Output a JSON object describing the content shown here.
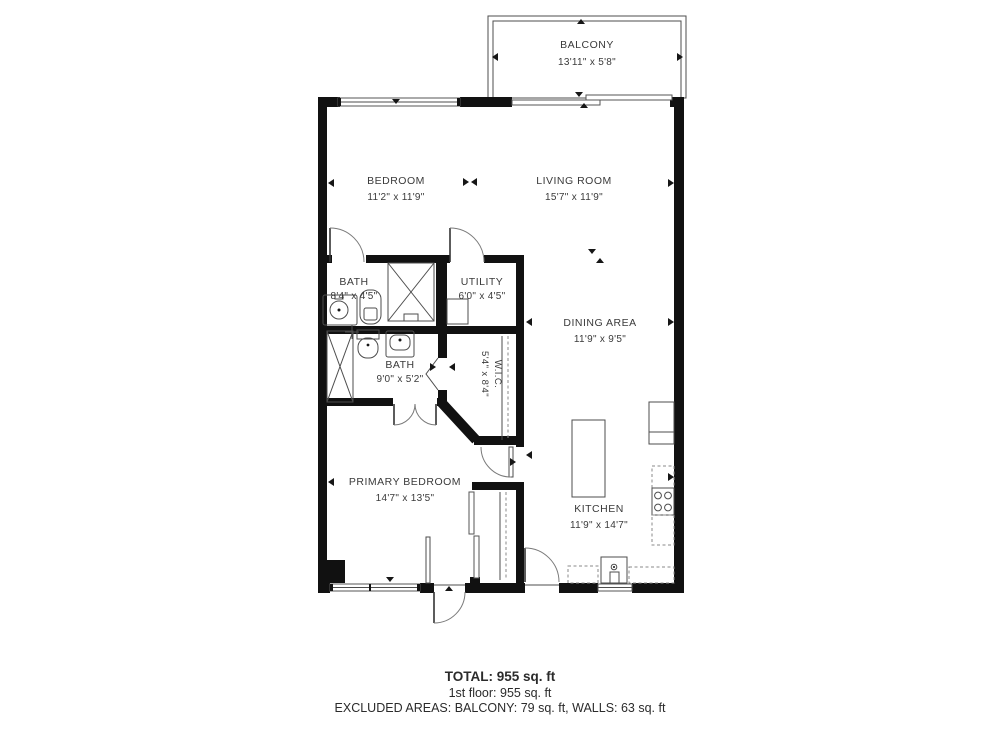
{
  "plan": {
    "balcony": {
      "label": "BALCONY",
      "dims": "13'11\" x 5'8\""
    },
    "rooms": {
      "bedroom": {
        "label": "BEDROOM",
        "dims": "11'2\" x 11'9\""
      },
      "living": {
        "label": "LIVING ROOM",
        "dims": "15'7\" x 11'9\""
      },
      "bath_top": {
        "label": "BATH",
        "dims": "8'4\" x 4'5\""
      },
      "utility": {
        "label": "UTILITY",
        "dims": "6'0\" x 4'5\""
      },
      "bath_primary": {
        "label": "BATH",
        "dims": "9'0\" x 5'2\""
      },
      "wic": {
        "label": "W.I.C.",
        "dims": "5'4\" x 8'4\""
      },
      "dining": {
        "label": "DINING AREA",
        "dims": "11'9\" x 9'5\""
      },
      "primary": {
        "label": "PRIMARY BEDROOM",
        "dims": "14'7\" x 13'5\""
      },
      "kitchen": {
        "label": "KITCHEN",
        "dims": "11'9\" x 14'7\""
      }
    }
  },
  "summary": {
    "total": "TOTAL: 955 sq. ft",
    "floor": "1st floor: 955 sq. ft",
    "excluded": "EXCLUDED AREAS: BALCONY: 79 sq. ft, WALLS: 63 sq. ft"
  }
}
